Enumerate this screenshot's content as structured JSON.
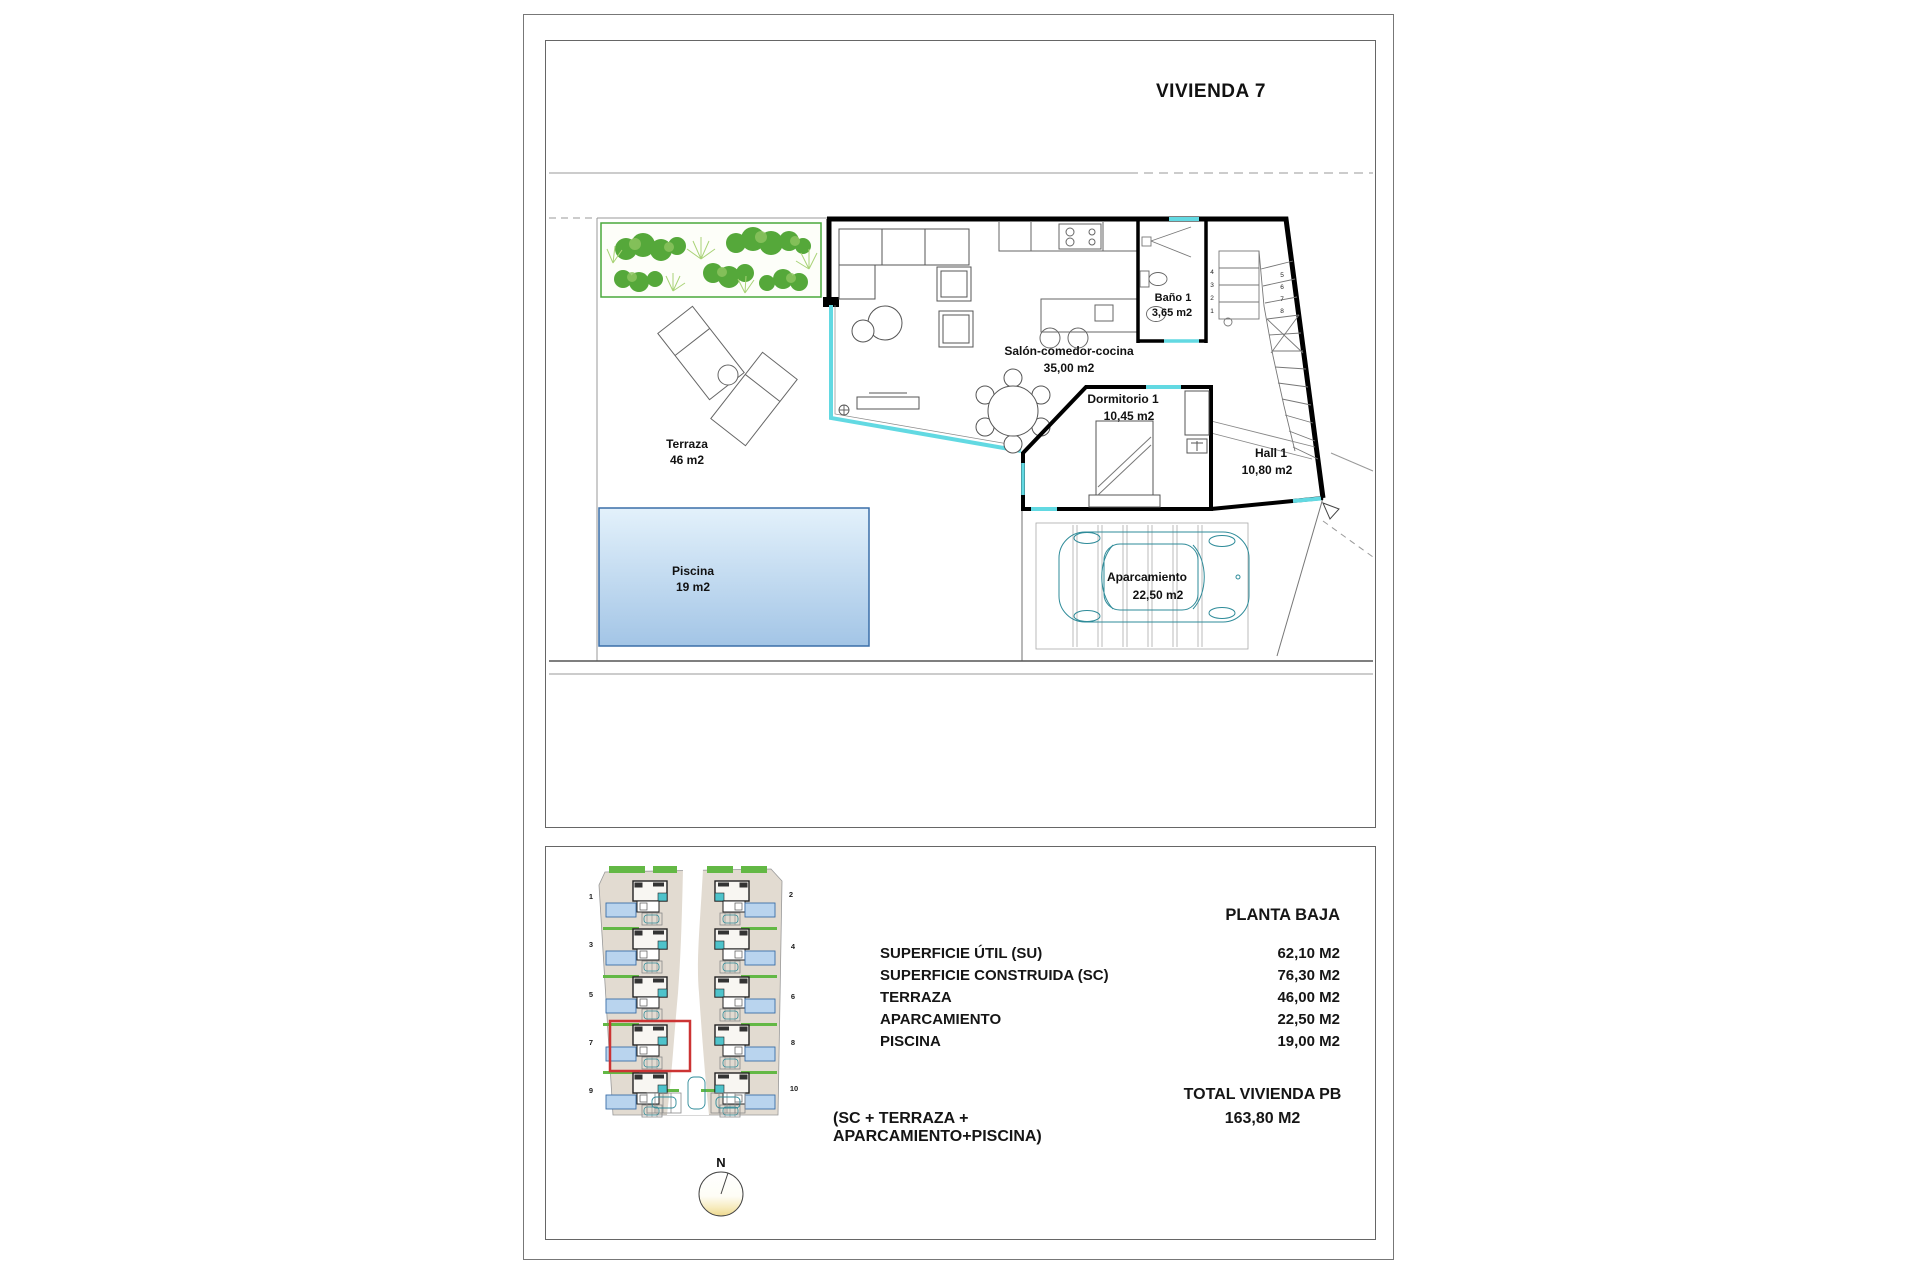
{
  "page": {
    "title": "VIVIENDA 7"
  },
  "floor_plan": {
    "rooms": {
      "terraza": {
        "name": "Terraza",
        "area": "46 m2"
      },
      "piscina": {
        "name": "Piscina",
        "area": "19 m2"
      },
      "salon": {
        "name": "Salón-comedor-cocina",
        "area": "35,00 m2"
      },
      "bano": {
        "name": "Baño 1",
        "area": "3,65 m2"
      },
      "dormitorio": {
        "name": "Dormitorio 1",
        "area": "10,45 m2"
      },
      "hall": {
        "name": "Hall 1",
        "area": "10,80 m2"
      },
      "aparcamiento": {
        "name": "Aparcamiento",
        "area": "22,50 m2"
      }
    },
    "stair_steps": [
      "1",
      "2",
      "3",
      "4",
      "5",
      "6",
      "7",
      "8"
    ]
  },
  "site_plan": {
    "unit_numbers": [
      "1",
      "2",
      "3",
      "4",
      "5",
      "6",
      "7",
      "8",
      "9",
      "10"
    ],
    "highlighted_unit": "7",
    "compass_label": "N"
  },
  "summary": {
    "header": "PLANTA BAJA",
    "rows": [
      {
        "label": "SUPERFICIE ÚTIL (SU)",
        "value": "62,10 M2"
      },
      {
        "label": "SUPERFICIE CONSTRUIDA (SC)",
        "value": "76,30 M2"
      },
      {
        "label": "TERRAZA",
        "value": "46,00 M2"
      },
      {
        "label": "APARCAMIENTO",
        "value": "22,50 M2"
      },
      {
        "label": "PISCINA",
        "value": "19,00 M2"
      }
    ],
    "formula": "(SC + TERRAZA + APARCAMIENTO+PISCINA)",
    "total_label": "TOTAL VIVIENDA PB",
    "total_value": "163,80 M2"
  },
  "colors": {
    "wall": "#000000",
    "glass_cyan": "#62d9e2",
    "pool_border": "#3a6ea8",
    "plant_green": "#55a83a",
    "car_teal": "#2e8b99",
    "highlight_red": "#cc3333",
    "site_beige": "#e2dbd1"
  }
}
